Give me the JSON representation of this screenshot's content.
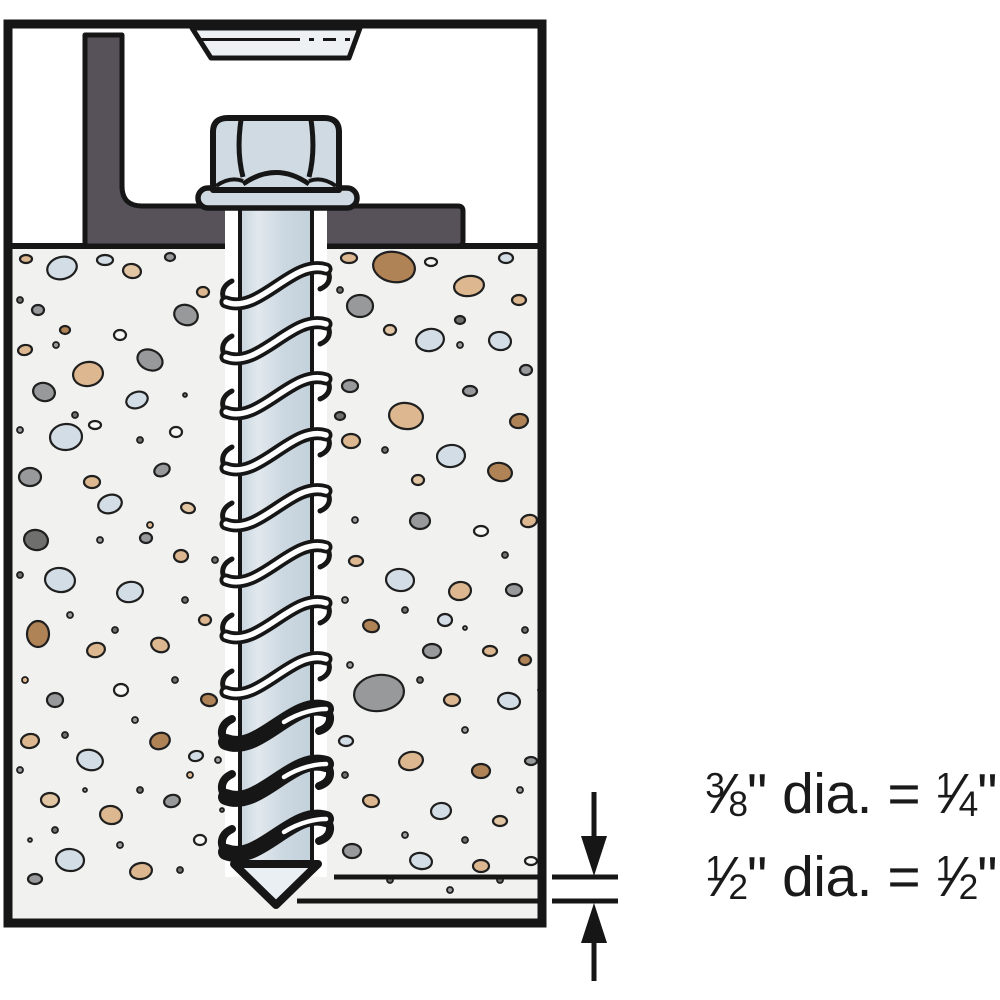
{
  "diagram": {
    "title": "Screw anchor installed through angle bracket into concrete (hole depth beyond anchor)",
    "fraction_slash": "⁄",
    "note_lines": [
      {
        "frac1_num": "3",
        "frac1_den": "8",
        "middle": "\" dia. = ",
        "frac2_num": "1",
        "frac2_den": "4",
        "suffix": "\""
      },
      {
        "frac1_num": "1",
        "frac1_den": "2",
        "middle": "\" dia. = ",
        "frac2_num": "1",
        "frac2_den": "2",
        "suffix": "\""
      }
    ]
  },
  "colors": {
    "outline": "#161616",
    "steel": "#cfdae3",
    "steel_light": "#e2e9ee",
    "steel_dark": "#c3d1db",
    "bracket": "#57525a",
    "fixture": "#eef1f4",
    "concrete": "#f1f1ef",
    "tip_fill": "#e9eff3",
    "hole": "#ffffff",
    "aggregate_palette": [
      "#d3dde5",
      "#dcb78f",
      "#97999b",
      "#b08357",
      "#6f6f6d",
      "#f7f7f5",
      "#e2c6a4"
    ]
  },
  "screw": {
    "thread_rows_light": [
      302,
      357,
      412,
      468,
      524,
      580,
      636,
      692
    ],
    "thread_rows_dark": [
      742,
      797,
      852
    ]
  },
  "concrete": {
    "stones": [
      [
        62,
        268,
        15,
        11,
        -15,
        0
      ],
      [
        132,
        271,
        9,
        7,
        10,
        6
      ],
      [
        186,
        315,
        12,
        10,
        20,
        2
      ],
      [
        38,
        310,
        6,
        5,
        0,
        2
      ],
      [
        88,
        374,
        15,
        12,
        -10,
        1
      ],
      [
        150,
        360,
        13,
        10,
        25,
        2
      ],
      [
        137,
        400,
        11,
        8,
        -20,
        0
      ],
      [
        44,
        392,
        11,
        9,
        15,
        2
      ],
      [
        66,
        437,
        16,
        13,
        -5,
        0
      ],
      [
        30,
        477,
        11,
        9,
        0,
        2
      ],
      [
        110,
        504,
        12,
        9,
        -18,
        0
      ],
      [
        36,
        540,
        12,
        10,
        12,
        4
      ],
      [
        92,
        482,
        8,
        6,
        0,
        1
      ],
      [
        162,
        470,
        8,
        6,
        -25,
        2
      ],
      [
        176,
        432,
        6,
        5,
        0,
        5
      ],
      [
        60,
        580,
        15,
        12,
        8,
        0
      ],
      [
        130,
        592,
        13,
        10,
        -12,
        0
      ],
      [
        181,
        556,
        7,
        6,
        0,
        1
      ],
      [
        38,
        634,
        11,
        13,
        0,
        3
      ],
      [
        96,
        650,
        9,
        7,
        -15,
        1
      ],
      [
        160,
        645,
        9,
        7,
        18,
        1
      ],
      [
        55,
        700,
        8,
        7,
        0,
        2
      ],
      [
        121,
        690,
        7,
        6,
        0,
        5
      ],
      [
        30,
        741,
        9,
        7,
        -10,
        1
      ],
      [
        90,
        760,
        13,
        10,
        15,
        0
      ],
      [
        160,
        741,
        10,
        8,
        -20,
        3
      ],
      [
        50,
        800,
        9,
        7,
        0,
        6
      ],
      [
        111,
        815,
        11,
        9,
        10,
        1
      ],
      [
        172,
        801,
        8,
        6,
        -15,
        2
      ],
      [
        70,
        860,
        14,
        11,
        5,
        0
      ],
      [
        141,
        871,
        11,
        8,
        -10,
        1
      ],
      [
        35,
        879,
        7,
        5,
        0,
        2
      ],
      [
        200,
        840,
        6,
        5,
        0,
        5
      ],
      [
        205,
        620,
        6,
        5,
        0,
        1
      ],
      [
        209,
        700,
        8,
        6,
        12,
        3
      ],
      [
        196,
        756,
        7,
        5,
        -10,
        0
      ],
      [
        105,
        260,
        8,
        5,
        0,
        0
      ],
      [
        26,
        259,
        6,
        4,
        0,
        1
      ],
      [
        170,
        257,
        5,
        4,
        0,
        2
      ],
      [
        203,
        292,
        6,
        5,
        0,
        1
      ],
      [
        120,
        335,
        6,
        5,
        0,
        5
      ],
      [
        25,
        350,
        7,
        5,
        -10,
        1
      ],
      [
        65,
        330,
        5,
        4,
        0,
        3
      ],
      [
        95,
        425,
        6,
        4,
        0,
        5
      ],
      [
        188,
        508,
        7,
        5,
        15,
        6
      ],
      [
        146,
        538,
        6,
        5,
        0,
        2
      ],
      [
        394,
        267,
        21,
        15,
        10,
        3
      ],
      [
        469,
        286,
        15,
        10,
        -8,
        1
      ],
      [
        360,
        306,
        13,
        11,
        0,
        2
      ],
      [
        519,
        300,
        7,
        5,
        0,
        1
      ],
      [
        430,
        340,
        14,
        11,
        -12,
        0
      ],
      [
        500,
        341,
        11,
        9,
        10,
        0
      ],
      [
        350,
        386,
        8,
        6,
        0,
        2
      ],
      [
        470,
        391,
        7,
        5,
        0,
        2
      ],
      [
        406,
        416,
        17,
        13,
        8,
        1
      ],
      [
        519,
        421,
        9,
        7,
        -10,
        3
      ],
      [
        351,
        441,
        9,
        7,
        0,
        1
      ],
      [
        451,
        456,
        14,
        11,
        -6,
        0
      ],
      [
        500,
        472,
        12,
        9,
        12,
        3
      ],
      [
        420,
        521,
        10,
        8,
        0,
        2
      ],
      [
        481,
        531,
        7,
        5,
        0,
        5
      ],
      [
        529,
        521,
        8,
        6,
        -12,
        1
      ],
      [
        356,
        561,
        7,
        5,
        0,
        1
      ],
      [
        400,
        580,
        14,
        11,
        6,
        0
      ],
      [
        460,
        591,
        11,
        9,
        -10,
        1
      ],
      [
        514,
        590,
        8,
        6,
        0,
        2
      ],
      [
        371,
        626,
        8,
        6,
        15,
        3
      ],
      [
        432,
        651,
        9,
        7,
        0,
        2
      ],
      [
        490,
        651,
        7,
        5,
        0,
        1
      ],
      [
        379,
        693,
        25,
        18,
        -8,
        2
      ],
      [
        452,
        700,
        8,
        6,
        0,
        1
      ],
      [
        509,
        701,
        11,
        8,
        10,
        0
      ],
      [
        346,
        741,
        7,
        5,
        0,
        0
      ],
      [
        411,
        761,
        12,
        9,
        -12,
        1
      ],
      [
        481,
        771,
        9,
        7,
        0,
        3
      ],
      [
        531,
        761,
        6,
        4,
        0,
        2
      ],
      [
        371,
        801,
        8,
        6,
        10,
        1
      ],
      [
        441,
        811,
        10,
        8,
        -8,
        0
      ],
      [
        500,
        821,
        7,
        5,
        0,
        6
      ],
      [
        352,
        851,
        9,
        7,
        0,
        2
      ],
      [
        421,
        861,
        11,
        8,
        10,
        0
      ],
      [
        481,
        866,
        8,
        6,
        0,
        1
      ],
      [
        531,
        861,
        6,
        4,
        0,
        5
      ],
      [
        349,
        258,
        8,
        5,
        0,
        1
      ],
      [
        431,
        262,
        6,
        4,
        0,
        5
      ],
      [
        506,
        258,
        7,
        5,
        0,
        0
      ],
      [
        390,
        330,
        6,
        5,
        0,
        6
      ],
      [
        460,
        320,
        5,
        4,
        0,
        4
      ],
      [
        526,
        370,
        6,
        5,
        0,
        2
      ],
      [
        340,
        416,
        5,
        4,
        0,
        4
      ],
      [
        418,
        480,
        6,
        5,
        0,
        6
      ],
      [
        445,
        620,
        7,
        6,
        0,
        0
      ],
      [
        525,
        660,
        6,
        5,
        0,
        3
      ]
    ],
    "specks": [
      [
        20,
        300,
        3,
        4
      ],
      [
        56,
        345,
        3,
        2
      ],
      [
        75,
        415,
        3,
        4
      ],
      [
        20,
        430,
        3,
        2
      ],
      [
        140,
        440,
        3,
        4
      ],
      [
        185,
        395,
        2,
        4
      ],
      [
        100,
        540,
        3,
        2
      ],
      [
        20,
        575,
        3,
        4
      ],
      [
        150,
        525,
        3,
        1
      ],
      [
        185,
        600,
        3,
        4
      ],
      [
        70,
        615,
        3,
        2
      ],
      [
        115,
        630,
        3,
        4
      ],
      [
        25,
        680,
        3,
        1
      ],
      [
        175,
        680,
        3,
        4
      ],
      [
        135,
        720,
        3,
        2
      ],
      [
        65,
        735,
        3,
        4
      ],
      [
        20,
        770,
        3,
        2
      ],
      [
        140,
        790,
        3,
        4
      ],
      [
        85,
        790,
        2,
        2
      ],
      [
        190,
        775,
        3,
        1
      ],
      [
        55,
        830,
        3,
        4
      ],
      [
        120,
        845,
        3,
        2
      ],
      [
        180,
        870,
        3,
        4
      ],
      [
        30,
        840,
        2,
        2
      ],
      [
        340,
        290,
        3,
        4
      ],
      [
        460,
        345,
        3,
        2
      ],
      [
        385,
        450,
        3,
        4
      ],
      [
        355,
        520,
        3,
        2
      ],
      [
        505,
        555,
        3,
        4
      ],
      [
        345,
        600,
        3,
        2
      ],
      [
        405,
        610,
        3,
        4
      ],
      [
        465,
        628,
        2,
        2
      ],
      [
        525,
        630,
        3,
        4
      ],
      [
        350,
        665,
        3,
        2
      ],
      [
        420,
        680,
        3,
        4
      ],
      [
        465,
        730,
        3,
        2
      ],
      [
        345,
        775,
        3,
        4
      ],
      [
        405,
        835,
        3,
        2
      ],
      [
        465,
        840,
        3,
        4
      ],
      [
        520,
        790,
        3,
        2
      ],
      [
        390,
        880,
        3,
        4
      ],
      [
        450,
        890,
        3,
        2
      ],
      [
        500,
        880,
        3,
        4
      ],
      [
        540,
        690,
        2,
        2
      ],
      [
        215,
        560,
        3,
        4
      ],
      [
        218,
        760,
        3,
        2
      ],
      [
        222,
        810,
        2,
        4
      ]
    ]
  }
}
